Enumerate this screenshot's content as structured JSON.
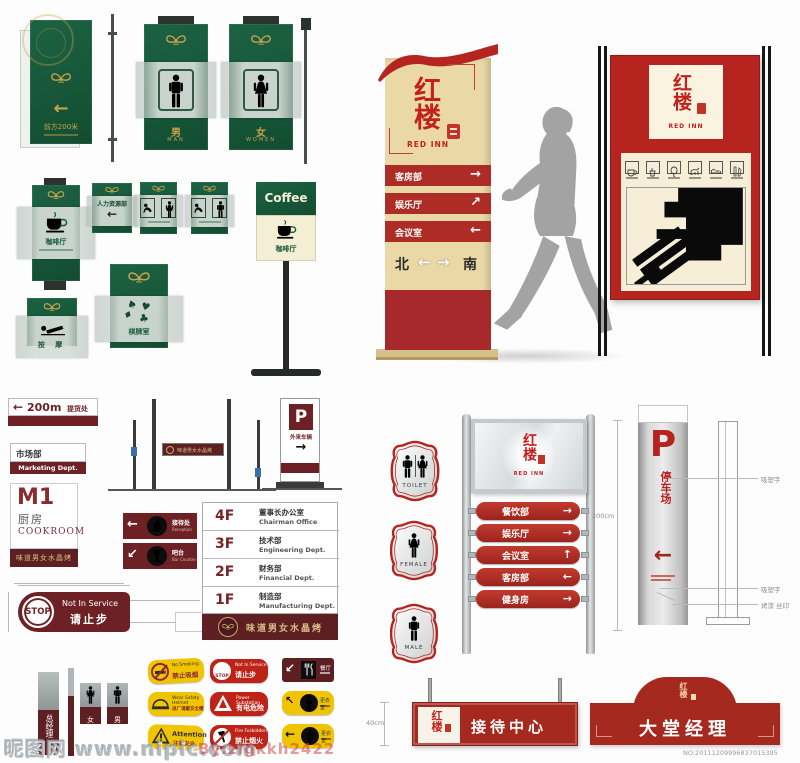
{
  "colors": {
    "green": "#17593a",
    "gold": "#c9a24b",
    "maroon": "#6e2125",
    "dark_red": "#5e1f22",
    "bright_red": "#b5241e",
    "cream": "#ead9a7",
    "yellow": "#f0c400",
    "silver": "#c9c9c9"
  },
  "watermark": {
    "site": "昵图网 www.nipic.com",
    "author": "By:zlgkkh2422",
    "serial": "NO:20111209996837015395"
  },
  "green": {
    "sign200m": {
      "arrow": "←",
      "label": "前方200米"
    },
    "male": {
      "cn": "男",
      "en": "MAN"
    },
    "female": {
      "cn": "女",
      "en": "WOMEN"
    },
    "coffee_hang": {
      "label": "咖啡厅"
    },
    "hr": {
      "label": "人力资源部",
      "arrow": "←"
    },
    "chess": {
      "label": "棋牌室",
      "suits": [
        "♠",
        "♥",
        "♦",
        "♣"
      ]
    },
    "massage": {
      "label": "按 摩"
    },
    "coffee_stand": {
      "en": "Coffee",
      "cn": "咖啡厅"
    }
  },
  "pylon": {
    "logo": {
      "cn": "红楼",
      "en": "RED INN"
    },
    "rows": [
      {
        "label": "客房部",
        "arrow": "→"
      },
      {
        "label": "娱乐厅",
        "arrow": "↗"
      },
      {
        "label": "会议室",
        "arrow": "←"
      }
    ],
    "compass": {
      "north": "北",
      "left": "←",
      "right": "→",
      "south": "南"
    }
  },
  "board": {
    "logo": {
      "cn": "红楼",
      "en": "RED INN"
    },
    "facility_icons": [
      "teacup-icon",
      "kettle-icon",
      "balloon-icon",
      "pet-icon",
      "bed-icon",
      "drink-icon"
    ]
  },
  "left": {
    "pickup": {
      "arrow": "←",
      "distance": "200m",
      "label": "提货处"
    },
    "marketing": {
      "cn": "市场部",
      "en": "Marketing  Dept."
    },
    "m1": {
      "code": "M1",
      "cn": "厨房",
      "en": "COOKROOM",
      "banner": "味道男女水晶烤"
    },
    "stop": {
      "word": "STOP",
      "en": "Not In Service",
      "cn": "请止步"
    },
    "dirs": [
      {
        "arrow": "←",
        "icon": "hand-icon",
        "cn": "接待处",
        "en": "Reception"
      },
      {
        "arrow": "↙",
        "icon": "goblet-icon",
        "cn": "吧台",
        "en": "Bar Counter"
      }
    ],
    "directory": {
      "rows": [
        {
          "floor": "4F",
          "cn": "董事长办公室",
          "en": "Chairman  Office"
        },
        {
          "floor": "3F",
          "cn": "技术部",
          "en": "Engineering  Dept."
        },
        {
          "floor": "2F",
          "cn": "财务部",
          "en": "Financial  Dept."
        },
        {
          "floor": "1F",
          "cn": "制造部",
          "en": "Manufacturing  Dept."
        }
      ],
      "banner": "味道男女水晶烤"
    },
    "strip": {
      "label": "味道男女水晶烤"
    },
    "p_small": {
      "p": "P",
      "label": "外来车辆",
      "arrow": "→"
    },
    "manager": {
      "label": "总经理"
    },
    "mini_female": {
      "label": "女"
    },
    "mini_male": {
      "label": "男"
    }
  },
  "safety": {
    "no_smoking": {
      "en": "No Smoking",
      "cn": "禁止吸烟"
    },
    "stop": {
      "word": "STOP",
      "en": "Not In Service",
      "cn": "请止步"
    },
    "canteen": {
      "arrow": "↙",
      "label": "餐厅"
    },
    "helmet": {
      "en": "Wear Safety Helmet",
      "cn": "进厂请戴安全帽"
    },
    "power": {
      "en": "Power Substation",
      "cn": "有电危险"
    },
    "locker1": {
      "arrow": "↖",
      "label": "更衣室"
    },
    "attention": {
      "en": "Attention",
      "cn": "注意安全"
    },
    "no_fire": {
      "en": "Fire Forbidden",
      "cn": "禁止烟火"
    },
    "locker2": {
      "arrow": "←",
      "label": "更衣室"
    }
  },
  "badges": {
    "toilet": "TOILET",
    "female": "FEMALE",
    "male": "MALE"
  },
  "pole_dir": {
    "logo": {
      "cn": "红楼",
      "en": "RED INN"
    },
    "slats": [
      {
        "label": "餐饮部",
        "arrow": "→"
      },
      {
        "label": "娱乐厅",
        "arrow": "→"
      },
      {
        "label": "会议室",
        "arrow": "↑"
      },
      {
        "label": "客房部",
        "arrow": "←"
      },
      {
        "label": "健身房",
        "arrow": "→"
      }
    ],
    "dim": "200cm"
  },
  "reception": {
    "logo_cn": "红楼",
    "label": "接待中心",
    "dim": "40cm"
  },
  "lobby": {
    "logo_cn": "红楼",
    "label": "大堂经理"
  },
  "parking": {
    "p": "P",
    "label": "停车场",
    "arrow": "←",
    "callout1": "吸塑字",
    "callout2": "吸塑字",
    "callout3": "烤漆 丝印"
  }
}
